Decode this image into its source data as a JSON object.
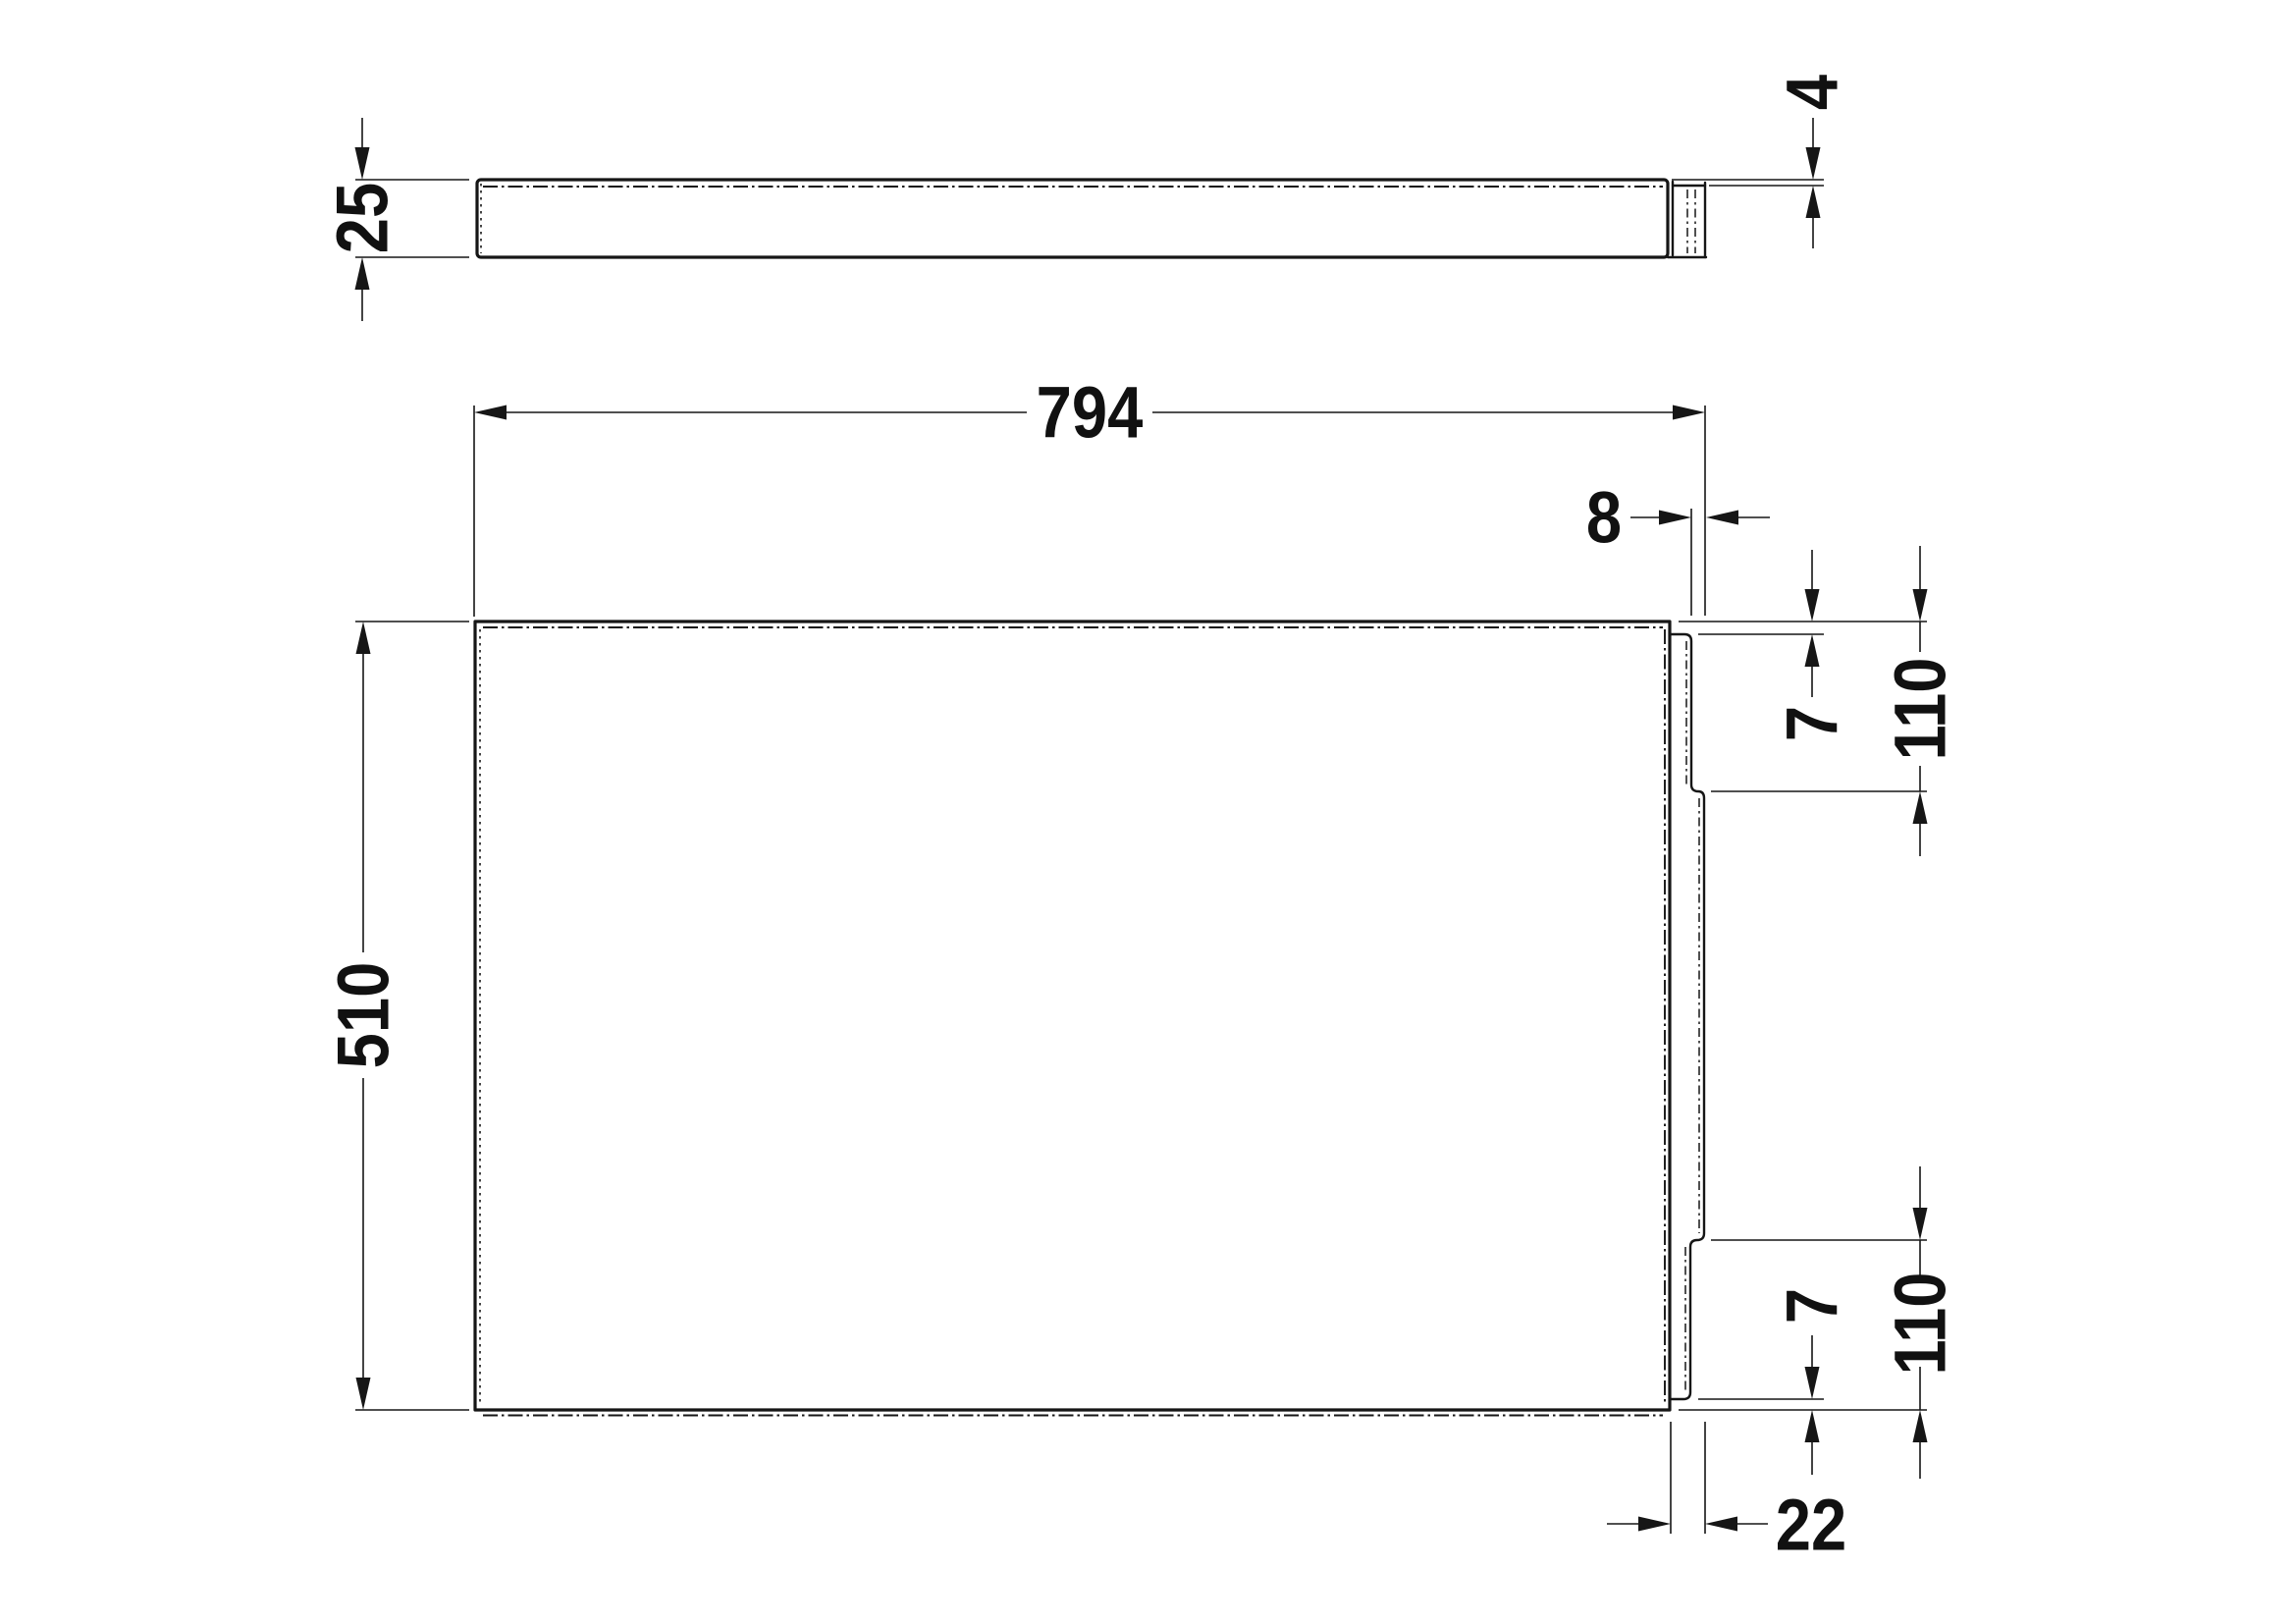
{
  "drawing": {
    "type": "technical-drawing",
    "background": "#ffffff",
    "line_color": "#161616",
    "views": {
      "plan": {
        "name": "plan-view",
        "dims": {
          "thickness": "25",
          "lip_thickness": "4"
        }
      },
      "front": {
        "name": "front-view",
        "dims": {
          "overall_width": "794",
          "overall_height": "510",
          "flange_step": "8",
          "top_edge_inset": "7",
          "top_notch_height": "110",
          "bottom_notch_height": "110",
          "bottom_edge_inset": "7",
          "flange_width": "22"
        }
      }
    }
  }
}
